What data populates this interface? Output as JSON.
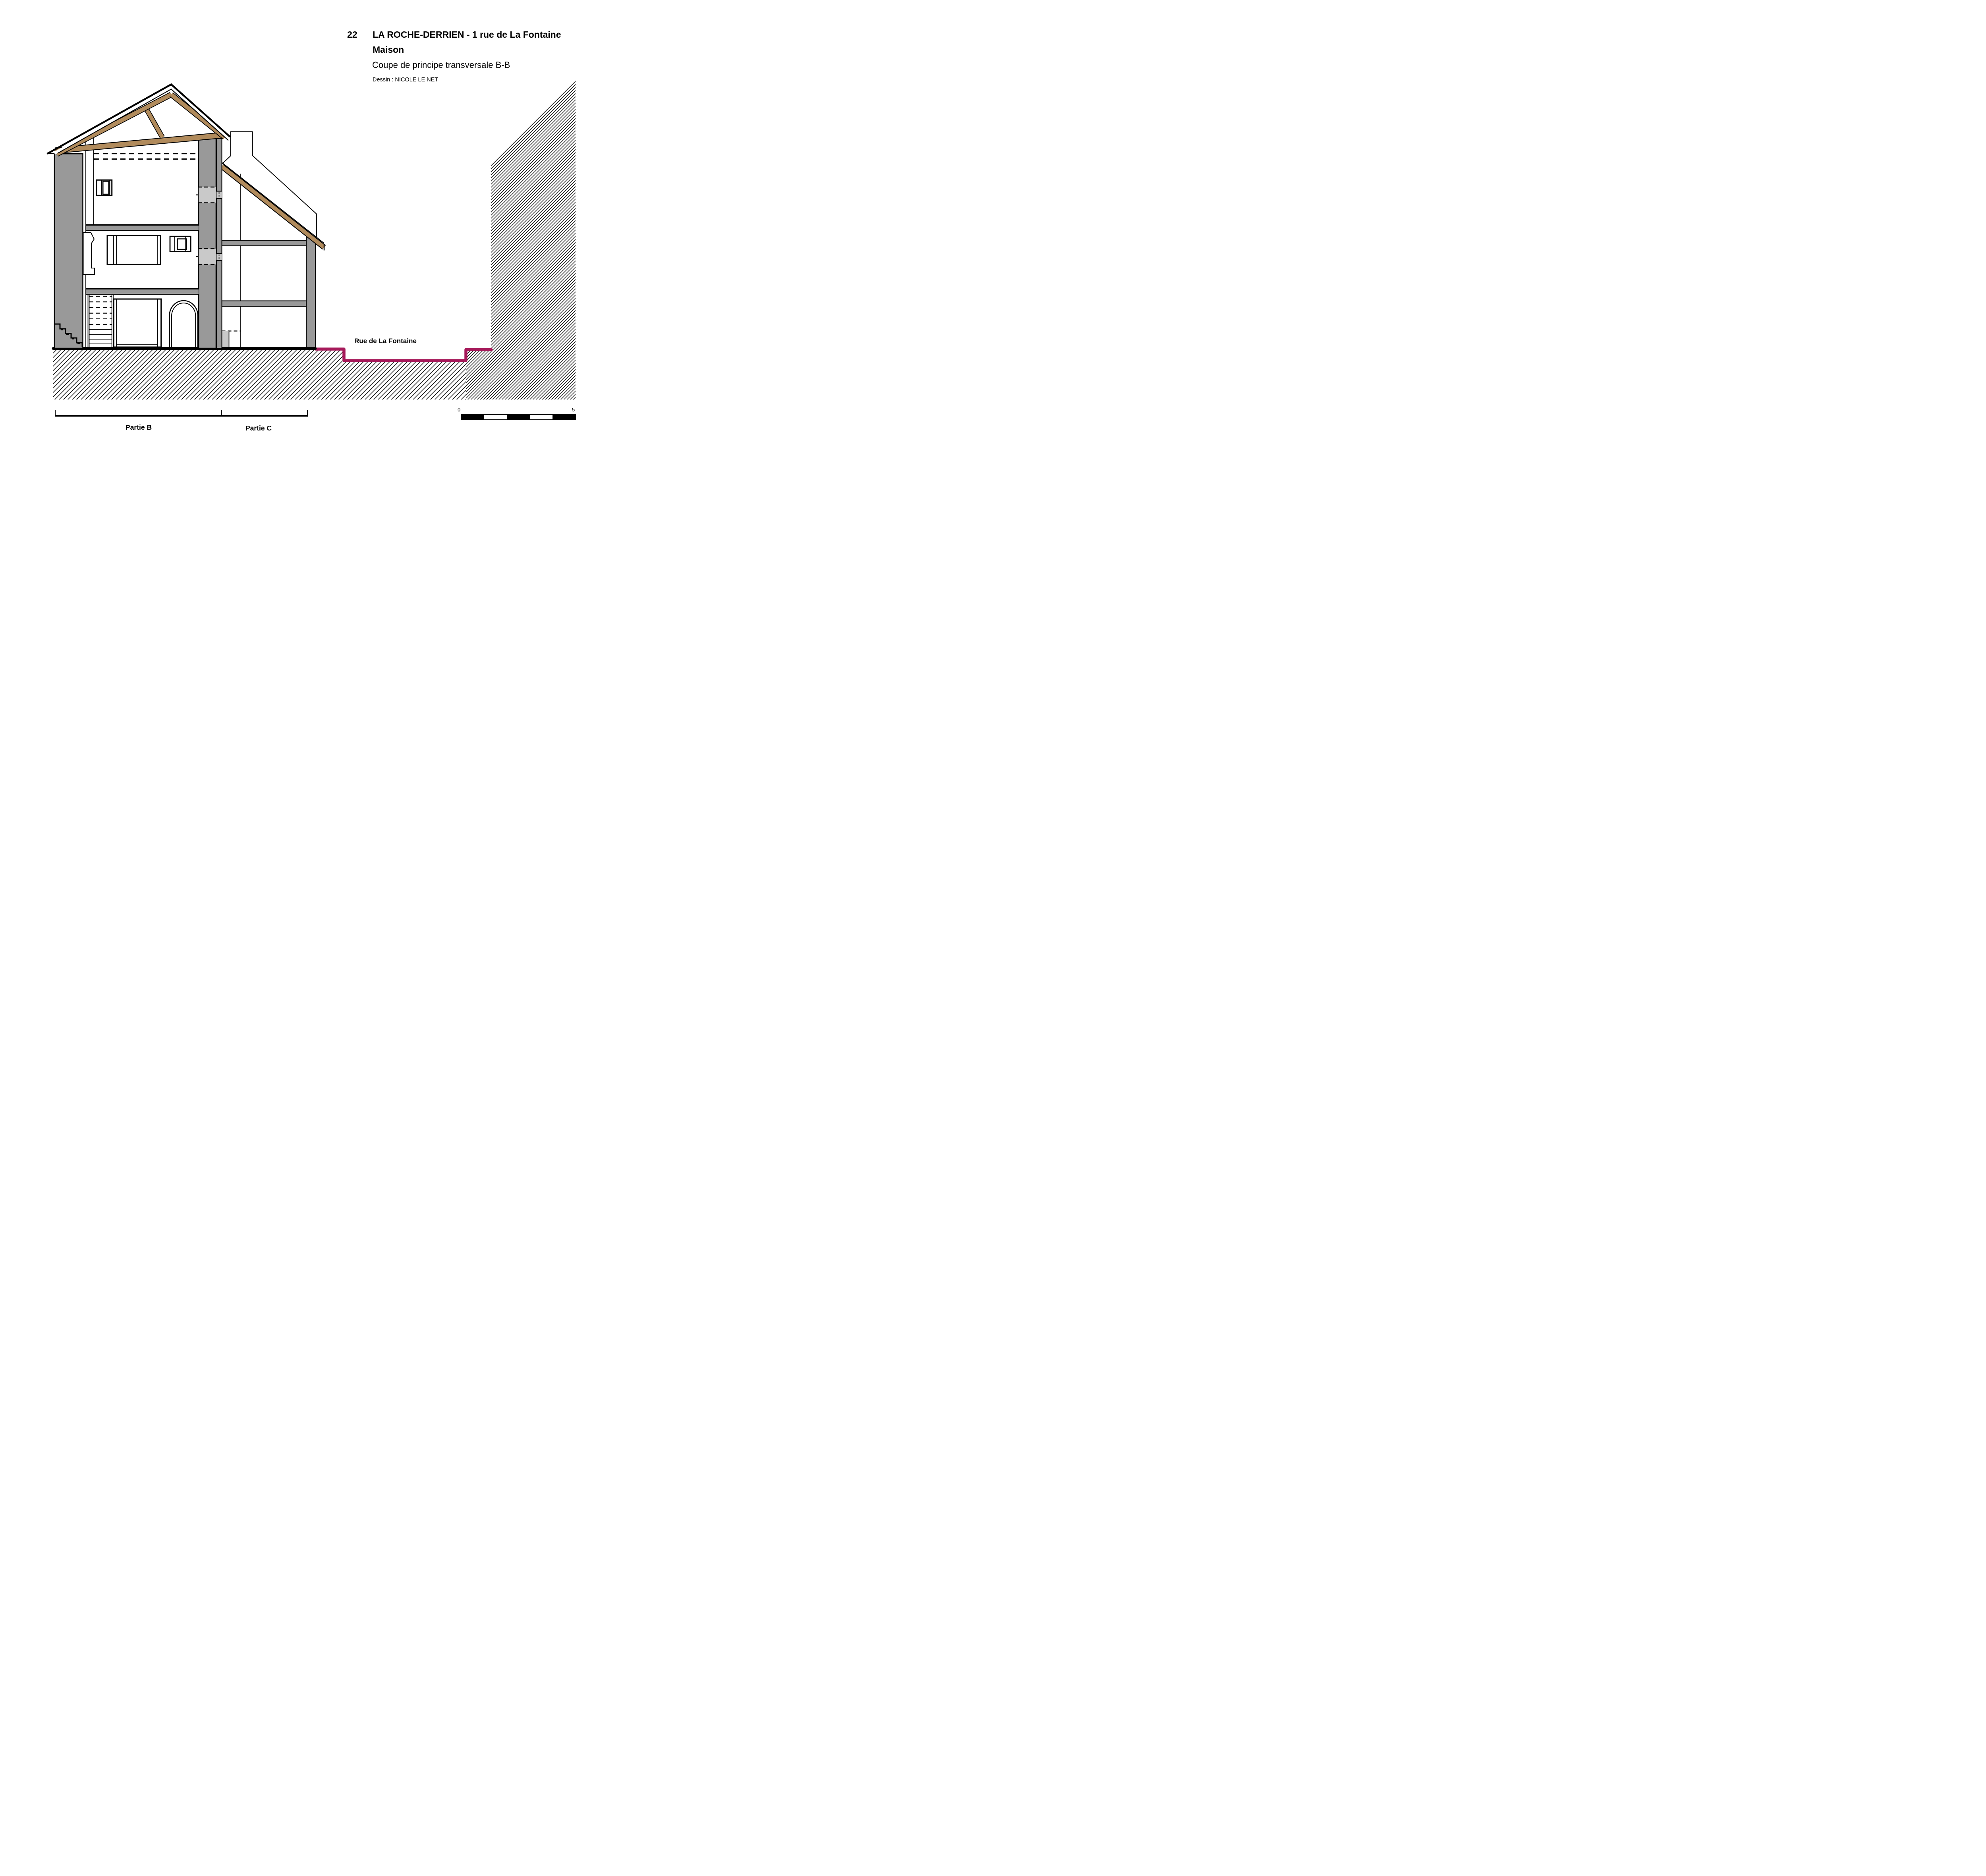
{
  "title_block": {
    "number": "22",
    "title": "LA ROCHE-DERRIEN - 1 rue de La Fontaine",
    "subtitle": "Maison",
    "drawing_type": "Coupe de principe transversale B-B",
    "credit": "Dessin : NICOLE LE NET"
  },
  "annotations": {
    "street_label": "Rue de La Fontaine",
    "part_b_label": "Partie B",
    "part_c_label": "Partie C"
  },
  "scale_bar": {
    "start_label": "0",
    "end_label": "5",
    "segments": 5
  },
  "drawing": {
    "type": "architectural-cross-section",
    "parts": [
      "Partie B",
      "Partie C"
    ],
    "features": [
      "timber roof truss",
      "chimney",
      "arched door",
      "stairs",
      "two floors",
      "street profile",
      "neighbor wall hatch",
      "ground hatch"
    ]
  },
  "colors": {
    "timber": "#b18b5c",
    "wall_gray": "#999999",
    "wall_light_gray": "#c9c9c9",
    "street_magenta": "#a6195a",
    "ink": "#000000",
    "paper": "#ffffff"
  }
}
